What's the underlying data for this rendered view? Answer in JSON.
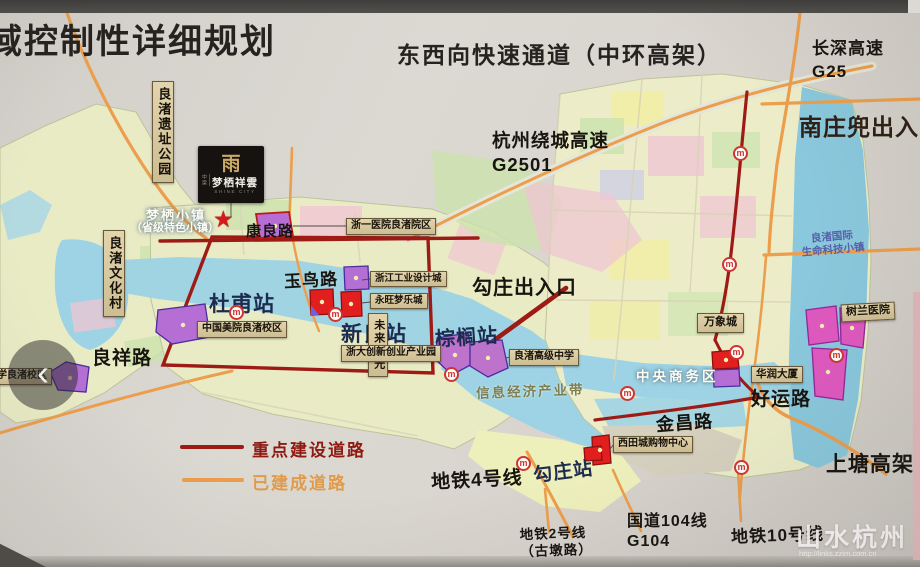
{
  "titles": {
    "plan": "域控制性详细规划",
    "corridor": "东西向快速通道（中环高架）"
  },
  "highways": {
    "changshen": {
      "name": "长深高速",
      "code": "G25"
    },
    "raocheng": {
      "name": "杭州绕城高速",
      "code": "G2501"
    },
    "guodao104": {
      "name": "国道104线",
      "code": "G104"
    },
    "shangtang": "上塘高架"
  },
  "interchanges": {
    "nanzhuangdou": "南庄兜出入口",
    "gouzhuang": "勾庄出入口"
  },
  "roads": {
    "kangliang": "康良路",
    "yuniao": "玉鸟路",
    "liangxiang": "良祥路",
    "haoyun": "好运路",
    "jinchang": "金昌路"
  },
  "metro": {
    "line4": "地铁4号线",
    "line2": "地铁2号线",
    "line2_sub": "（古墩路）",
    "line10": "地铁10号线",
    "icon_glyph": "m",
    "stations": {
      "dufu": "杜甫站",
      "xinliang": "新良站",
      "zonglv": "棕榈站",
      "gouzhuang": "勾庄站"
    }
  },
  "pois": {
    "liangzhu_park": "良渚遗址公园",
    "wenhua_village": "良渚文化村",
    "meiyuan": "中国美院良渚校区",
    "zheyi_hospital": "浙一医院良渚院区",
    "design_city": "浙江工业设计城",
    "aeon_mall": "永旺梦乐城",
    "future_light": "未来之光",
    "zheda_park": "浙大创新创业产业园",
    "gaoji_school": "良渚高级中学",
    "wanxiang_city": "万象城",
    "huarun_tower": "华润大厦",
    "xitian_mall": "西田城购物中心",
    "shulan_hospital": "树兰医院",
    "xiaoxue_campus": "小学良渚校区"
  },
  "areas": {
    "mengqi_town": "梦栖小镇",
    "mengqi_town_sub": "（省级特色小镇）",
    "cbd": "中央商务区",
    "info_belt": "信息经济产业带",
    "lz_intl_1": "良渚国际",
    "lz_intl_2": "生命科技小镇"
  },
  "legend": {
    "key_roads": "重点建设道路",
    "built_roads": "已建成道路",
    "key_color": "#9e1b15",
    "built_color": "#ec9e4c"
  },
  "logo": {
    "prefix": "中梁",
    "glyph": "雨",
    "name": "梦栖祥雲",
    "sub": "SHINE CITY"
  },
  "markers": {
    "star": "★"
  },
  "nav": {
    "prev": "‹"
  },
  "watermark": {
    "name": "山水杭州",
    "url": "http://links.zzim.com.cn"
  }
}
